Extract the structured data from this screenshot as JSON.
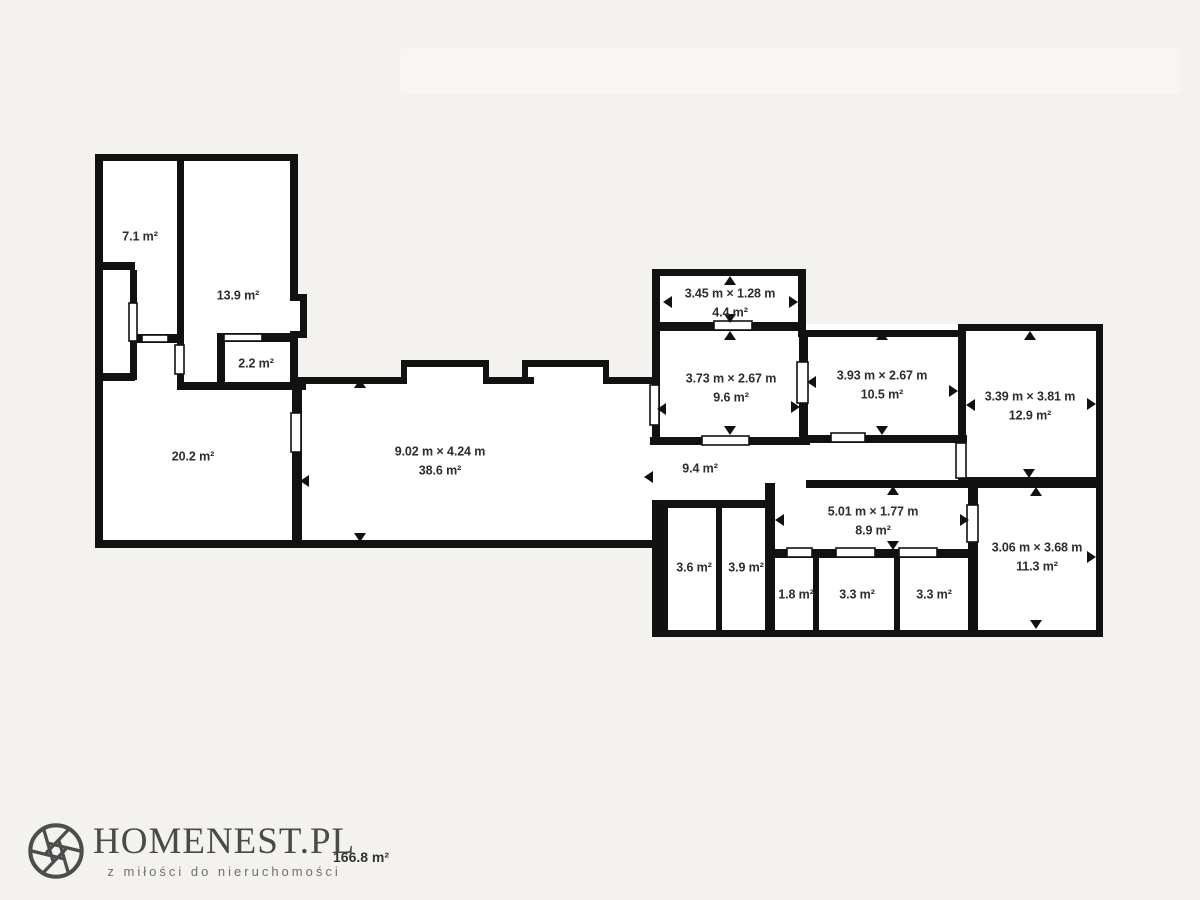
{
  "branding": {
    "logo_text": "HOMENEST.PL",
    "tagline": "z miłości do nieruchomości",
    "logo_icon": "aperture-icon"
  },
  "summary": {
    "total_area": "166.8 m²"
  },
  "floorplan": {
    "rooms": {
      "r71": {
        "area": "7.1 m²"
      },
      "r139": {
        "area": "13.9 m²"
      },
      "r22": {
        "area": "2.2 m²"
      },
      "r202": {
        "area": "20.2 m²"
      },
      "r386": {
        "dims": "9.02 m × 4.24 m",
        "area": "38.6 m²"
      },
      "r44": {
        "dims": "3.45 m × 1.28 m",
        "area": "4.4 m²"
      },
      "r96": {
        "dims": "3.73 m × 2.67 m",
        "area": "9.6 m²"
      },
      "r105": {
        "dims": "3.93 m × 2.67 m",
        "area": "10.5 m²"
      },
      "r129": {
        "dims": "3.39 m × 3.81 m",
        "area": "12.9 m²"
      },
      "r94": {
        "area": "9.4 m²"
      },
      "r89": {
        "dims": "5.01 m × 1.77 m",
        "area": "8.9 m²"
      },
      "r113": {
        "dims": "3.06 m × 3.68 m",
        "area": "11.3 m²"
      },
      "r36": {
        "area": "3.6 m²"
      },
      "r39": {
        "area": "3.9 m²"
      },
      "r18": {
        "area": "1.8 m²"
      },
      "r33a": {
        "area": "3.3 m²"
      },
      "r33b": {
        "area": "3.3 m²"
      }
    },
    "colors": {
      "walls": "#111111",
      "room_fill": "#ffffff",
      "background": "#f4f2ee",
      "label_text": "#2d2d2d",
      "logo_color": "#4a4a4a"
    }
  }
}
